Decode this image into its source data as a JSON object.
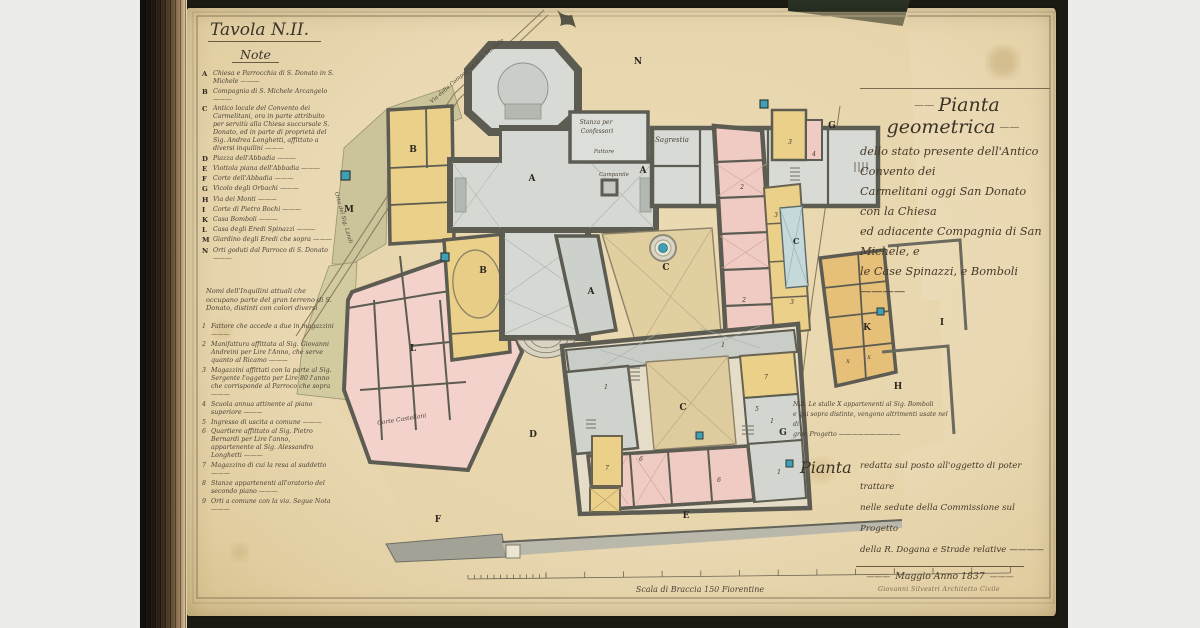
{
  "legend": {
    "title": "Tavola N.II.",
    "heading": "Note",
    "entries": [
      {
        "key": "A",
        "text": "Chiesa e Parrocchia di S. Donato in S. Michele"
      },
      {
        "key": "B",
        "text": "Compagnia di S. Michele Arcangelo"
      },
      {
        "key": "C",
        "text": "Antico locale del Convento dei Carmelitani, ora in parte attribuito per servitù alla Chiesa succursale S. Donato, ed in parte di proprietà del Sig. Andrea Longhetti, affittato a diversi inquilini"
      },
      {
        "key": "D",
        "text": "Piazza dell'Abbadia"
      },
      {
        "key": "E",
        "text": "Viottola piana dell'Abbadia"
      },
      {
        "key": "F",
        "text": "Corte dell'Abbadia"
      },
      {
        "key": "G",
        "text": "Vicolo degli Orbachi"
      },
      {
        "key": "H",
        "text": "Via dei Monti"
      },
      {
        "key": "I",
        "text": "Corte di Pietro Bochi"
      },
      {
        "key": "K",
        "text": "Casa Bomboli"
      },
      {
        "key": "L",
        "text": "Casa degli Eredi Spinazzi"
      },
      {
        "key": "M",
        "text": "Giardino degli Eredi che sopra"
      },
      {
        "key": "N",
        "text": "Orti goduti dal Parroco di S. Donato"
      }
    ],
    "tenants_intro": "Nomi dell'Inquilini attuali che occupano parte del gran terreno di S. Donato, distinti con colori diversi",
    "tenants": [
      {
        "num": "1",
        "text": "Fattore che accede a due in magazzini"
      },
      {
        "num": "2",
        "text": "Manifattura affittata al Sig. Giovanni Andreini per Lire l'Anno, che serve quanto al Ricamo"
      },
      {
        "num": "3",
        "text": "Magazzini affittati con la parte al Sig. Sergente l'oggetto per Lire 80 l'anno che corrisponde al Parroco che sopra"
      },
      {
        "num": "4",
        "text": "Scuola annua attinente al piano superiore"
      },
      {
        "num": "5",
        "text": "Ingresso di uscita a comune"
      },
      {
        "num": "6",
        "text": "Quartiere affittato al Sig. Pietro Bernardi per Lire l'anno, appartenente al Sig. Alessandro Longhetti"
      },
      {
        "num": "7",
        "text": "Magazzino di cui la resa al suddetto"
      },
      {
        "num": "8",
        "text": "Stanze appartenenti all'oratorio del secondo piano"
      },
      {
        "num": "9",
        "text": "Orti a comune con la via. Segue Nota"
      }
    ]
  },
  "title_block": {
    "title": "Pianta geometrica",
    "lines": [
      "dello stato presente dell'Antico Convento dei",
      "Carmelitani oggi San Donato con la Chiesa",
      "ed adiacente Compagnia di San Michele, e",
      "le Case Spinazzi, e Bomboli ————"
    ]
  },
  "nb_note": {
    "lines": [
      "N.B. Le stalle X appartenenti al Sig. Bomboli",
      "e qui sopra distinte, vengono altrimenti usate nel di",
      "gran Progetto ——————————"
    ]
  },
  "project_note": {
    "lead": "Pianta",
    "lines": [
      "redatta sul posto all'oggetto di poter trattare",
      "nelle sedute della Commissione sul Progetto",
      "della R. Dogana e Strade relative ————"
    ],
    "date": "Maggio Anno 1837"
  },
  "signature": "Giovanni Silvestri Architetto Civile",
  "scale_label": "Scala di Braccia 150 Fiorentine",
  "plan_labels": [
    {
      "text": "A",
      "x": 532,
      "y": 181,
      "size": 9,
      "cls": "letter"
    },
    {
      "text": "A",
      "x": 643,
      "y": 173,
      "size": 9,
      "cls": "letter"
    },
    {
      "text": "A",
      "x": 591,
      "y": 294,
      "size": 9,
      "cls": "letter"
    },
    {
      "text": "B",
      "x": 413,
      "y": 152,
      "size": 9,
      "cls": "letter"
    },
    {
      "text": "B",
      "x": 483,
      "y": 273,
      "size": 9,
      "cls": "letter"
    },
    {
      "text": "C",
      "x": 666,
      "y": 270,
      "size": 9,
      "cls": "letter"
    },
    {
      "text": "C",
      "x": 683,
      "y": 410,
      "size": 9,
      "cls": "letter"
    },
    {
      "text": "C",
      "x": 796,
      "y": 244,
      "size": 8,
      "cls": "letter"
    },
    {
      "text": "D",
      "x": 533,
      "y": 437,
      "size": 9,
      "cls": "letter"
    },
    {
      "text": "E",
      "x": 686,
      "y": 518,
      "size": 9,
      "cls": "letter"
    },
    {
      "text": "F",
      "x": 438,
      "y": 522,
      "size": 9,
      "cls": "letter"
    },
    {
      "text": "G",
      "x": 832,
      "y": 128,
      "size": 9,
      "cls": "letter"
    },
    {
      "text": "G",
      "x": 783,
      "y": 435,
      "size": 9,
      "cls": "letter"
    },
    {
      "text": "H",
      "x": 898,
      "y": 389,
      "size": 9,
      "cls": "letter"
    },
    {
      "text": "I",
      "x": 942,
      "y": 325,
      "size": 9,
      "cls": "letter"
    },
    {
      "text": "K",
      "x": 867,
      "y": 330,
      "size": 9,
      "cls": "letter"
    },
    {
      "text": "L",
      "x": 413,
      "y": 351,
      "size": 9,
      "cls": "letter"
    },
    {
      "text": "M",
      "x": 349,
      "y": 212,
      "size": 9,
      "cls": "letter"
    },
    {
      "text": "N",
      "x": 638,
      "y": 64,
      "size": 9,
      "cls": "letter"
    },
    {
      "text": "1",
      "x": 723,
      "y": 347,
      "size": 6,
      "cls": "num"
    },
    {
      "text": "1",
      "x": 606,
      "y": 389,
      "size": 6,
      "cls": "num"
    },
    {
      "text": "1",
      "x": 772,
      "y": 423,
      "size": 6,
      "cls": "num"
    },
    {
      "text": "1",
      "x": 779,
      "y": 474,
      "size": 6,
      "cls": "num"
    },
    {
      "text": "2",
      "x": 742,
      "y": 189,
      "size": 6,
      "cls": "num"
    },
    {
      "text": "2",
      "x": 744,
      "y": 302,
      "size": 6,
      "cls": "num"
    },
    {
      "text": "3",
      "x": 790,
      "y": 144,
      "size": 6,
      "cls": "num"
    },
    {
      "text": "3",
      "x": 776,
      "y": 217,
      "size": 6,
      "cls": "num"
    },
    {
      "text": "3",
      "x": 792,
      "y": 304,
      "size": 6,
      "cls": "num"
    },
    {
      "text": "4",
      "x": 814,
      "y": 156,
      "size": 6,
      "cls": "num"
    },
    {
      "text": "5",
      "x": 757,
      "y": 411,
      "size": 6,
      "cls": "num"
    },
    {
      "text": "6",
      "x": 641,
      "y": 461,
      "size": 6,
      "cls": "num"
    },
    {
      "text": "6",
      "x": 719,
      "y": 482,
      "size": 6,
      "cls": "num"
    },
    {
      "text": "7",
      "x": 607,
      "y": 470,
      "size": 6,
      "cls": "num"
    },
    {
      "text": "7",
      "x": 766,
      "y": 379,
      "size": 6,
      "cls": "num"
    },
    {
      "text": "X",
      "x": 848,
      "y": 363,
      "size": 5,
      "cls": "num"
    },
    {
      "text": "X",
      "x": 869,
      "y": 359,
      "size": 5,
      "cls": "num"
    },
    {
      "text": "Stanza per",
      "x": 596,
      "y": 124,
      "size": 6,
      "cls": "hand"
    },
    {
      "text": "Confessori",
      "x": 597,
      "y": 133,
      "size": 6,
      "cls": "hand"
    },
    {
      "text": "Sagrestia",
      "x": 672,
      "y": 142,
      "size": 7,
      "cls": "hand"
    },
    {
      "text": "Fattore",
      "x": 604,
      "y": 153,
      "size": 5.5,
      "cls": "hand"
    },
    {
      "text": "Campanile",
      "x": 614,
      "y": 176,
      "size": 5.5,
      "cls": "hand"
    },
    {
      "text": "Via della Compagnia di S. Michele",
      "x": 468,
      "y": 72,
      "size": 5.5,
      "cls": "hand",
      "rot": -41
    },
    {
      "text": "Orto del Sig. Landi",
      "x": 342,
      "y": 218,
      "size": 5.5,
      "cls": "hand",
      "rot": 74
    },
    {
      "text": "Corte Castellani",
      "x": 402,
      "y": 421,
      "size": 6,
      "cls": "hand",
      "rot": -9
    },
    {
      "text": "Scala di Braccia 150 Fiorentine",
      "x": 700,
      "y": 592,
      "size": 8,
      "cls": "hand"
    }
  ],
  "colors": {
    "paper": "#e9d9b6",
    "ink": "#4c4337",
    "wall_poche": "#5d5c52",
    "church_floor": "#d6d9d3",
    "pink_rooms": "#f0cbc4",
    "yellow_rooms": "#ead088",
    "orange_house": "#e6c078",
    "green_fields": "#cbc49a",
    "tan_courtyard": "#e2cfa0",
    "blue_room": "#c5d8da",
    "teal_well": "#3f9fb5",
    "cover": "#1c1a13"
  }
}
